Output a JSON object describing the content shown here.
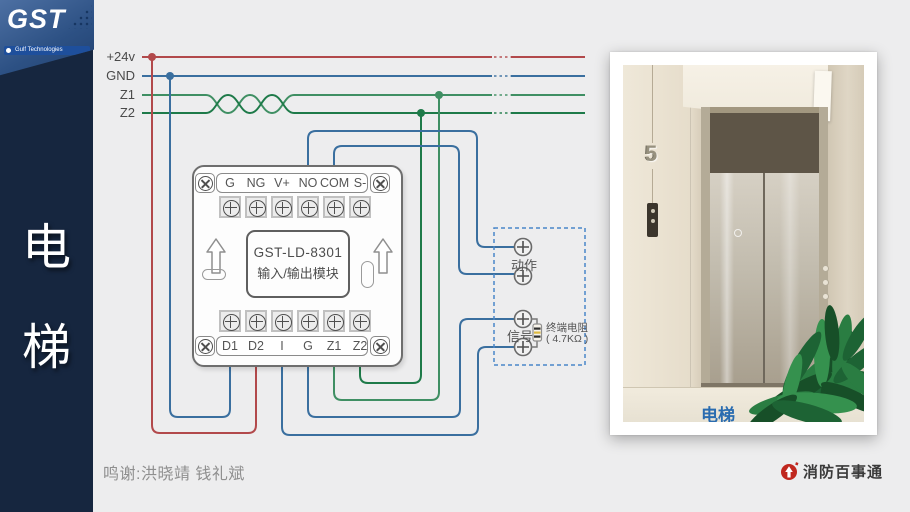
{
  "sidebar": {
    "char_top": "电",
    "char_bottom": "梯"
  },
  "logo": {
    "brand": "GST",
    "tagline": "Gulf Technologies"
  },
  "bus": {
    "labels": {
      "v24": "+24v",
      "gnd": "GND",
      "z1": "Z1",
      "z2": "Z2"
    }
  },
  "module": {
    "model": "GST-LD-8301",
    "name": "输入/输出模块",
    "top_terminals": [
      "G",
      "NG",
      "V+",
      "NO",
      "COM",
      "S-"
    ],
    "bottom_terminals": [
      "D1",
      "D2",
      "I",
      "G",
      "Z1",
      "Z2"
    ]
  },
  "field_box": {
    "action": "动作",
    "signal": "信号",
    "resistor_name": "终端电阻",
    "resistor_value": "( 4.7KΩ )"
  },
  "photo": {
    "caption": "电梯",
    "floor_sign": "5"
  },
  "footer": {
    "credits": "鸣谢:洪晓靖 钱礼斌",
    "brand": "消防百事通"
  },
  "colors": {
    "bus_24v": "#b2494b",
    "bus_gnd": "#3a6f9f",
    "bus_z1": "#3f8f63",
    "bus_z2": "#1e7a49",
    "dashed_box": "#4a86c8",
    "caption_blue": "#2a6cb0",
    "brand_red": "#c0271e",
    "sidebar_navy": "#16263f"
  }
}
